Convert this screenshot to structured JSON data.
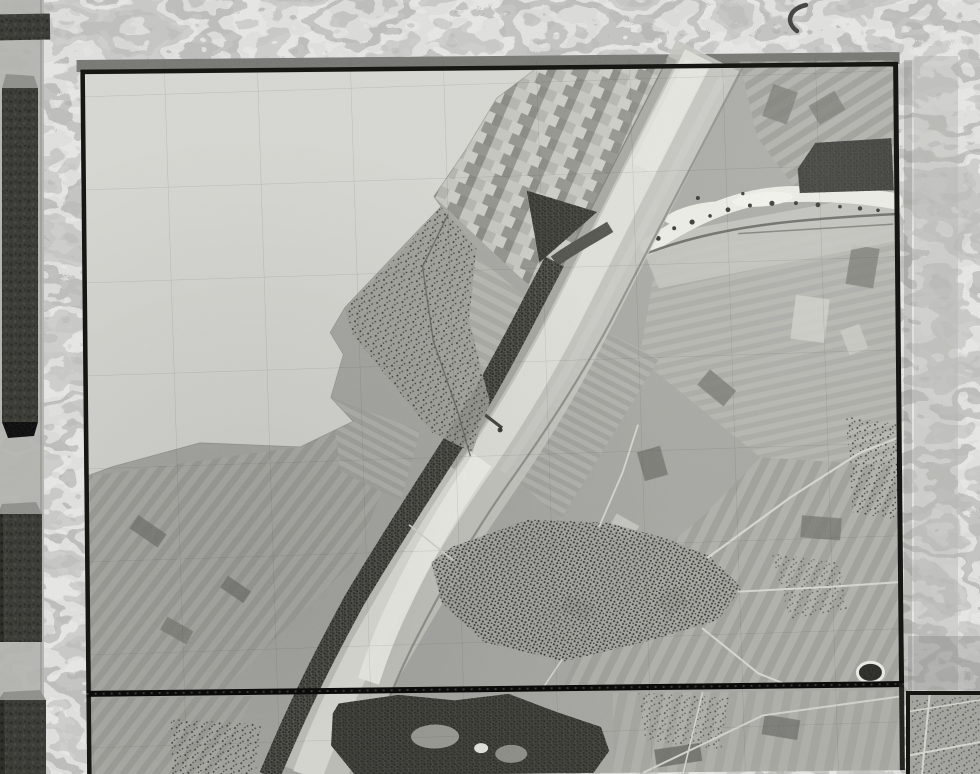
{
  "document": {
    "kind": "archival aerial photomosaic album page",
    "note": "grayscale vertical aerial survey mosaic (river/canal with villages and strip fields) mounted on a marbled album page; no visible text, labels or UI controls"
  },
  "palette": {
    "marble_base": "#9e9e9a",
    "tape": "#b2b2ae",
    "block_dark": "#30302b",
    "block_bevel": "#8d8d89",
    "sheet_shadow": "#747470",
    "border": "#161613",
    "divider": "#0b0b09",
    "paper_blank": "#d9d9d4",
    "photo_base": "#a7a7a2",
    "patch_tint": "#b9b9b3",
    "corridor": "#c8c8c2",
    "water": "#e2e2dc",
    "water_bright": "#f4f4ee",
    "sandbar": "#efefe8",
    "meadow": "#c5c5bf",
    "woods_base": "#4a4a44",
    "forest_base": "#3b3b35",
    "village_ground": "#a0a09a",
    "road_light": "#d8d8d2",
    "road_dark": "#5a5a54",
    "dike_dark": "#85857f",
    "pond_rim": "#eeeee8",
    "pond_fill": "#21211d",
    "grid_line": "#2d2d28",
    "margin_band": "#b6b6b2"
  },
  "geometry": {
    "canvas": {
      "width": 980,
      "height": 774
    },
    "main_sheet": {
      "x": 84,
      "y": 66,
      "width": 817,
      "height": 708
    },
    "divider_y": 690,
    "corner_sheet": {
      "x": 906,
      "y": 691,
      "width": 74,
      "height": 83
    },
    "grid": {
      "spacing_px": 93,
      "tilt_deg": -1.3
    }
  },
  "features": {
    "blank_area_points": "84,70 538,70 500,98 468,150 436,196 443,206 404,246 346,306 331,331 344,353 331,396 353,420 300,445 200,440 112,463 84,473",
    "checkerboard_points": "538,70 668,70 548,302 505,262 436,196 468,150 500,98",
    "woods_triangle_points": "529,191 599,213 541,263",
    "dark_block_topright_points": "800,172 818,146 894,142 896,194 802,196",
    "canal": {
      "corridor_d": "M 712,58 L 576,320 C 544,382 512,432 474,486 C 436,540 402,596 368,654 C 344,696 322,734 306,774",
      "water_d": "M 702,58 L 566,320 C 534,380 504,428 468,478 C 432,530 398,586 364,644 C 342,686 320,730 304,774",
      "bright_d": "M 482,460 C 448,508 420,556 396,606 C 384,630 374,656 366,680",
      "upper_bright_d": "M 700,66 L 646,170",
      "left_dike_d": "M 676,60 L 542,318 C 512,372 484,418 450,466",
      "towpath_d": "M 726,80 L 596,320 C 566,376 536,424 502,472",
      "right_dike_d": "M 748,66 L 612,322 C 580,380 548,428 512,478 C 474,530 440,588 410,646 C 390,686 372,728 360,774",
      "woods_upper_d": "M 612,228 C 592,240 572,250 556,262",
      "woods_d": "M 556,262 C 520,330 488,392 456,438 C 422,490 386,544 352,600 C 320,658 296,704 266,774"
    },
    "old_channel": {
      "meadow_points": "640,240 897,195 897,245 660,290",
      "shore_d": "M 650,248 C 700,215 745,198 790,197 C 835,196 870,200 897,205",
      "dark_shore_d": "M 648,255 C 720,228 800,222 897,218",
      "dark_shore2_d": "M 740,236 L 895,228"
    },
    "bridge_d": "M 466,400 L 502,428",
    "village_band_points": "443,206 478,248 470,320 490,402 472,452 432,432 394,384 354,334 346,308 406,248",
    "village_band_road_d": "M 450,214 L 424,266 L 434,340 L 458,412 L 470,456",
    "big_village_points": "452,546 528,520 608,524 664,540 708,558 740,590 716,622 648,642 562,662 482,642 440,602 430,562",
    "village_roads": [
      "M 706,560 L 790,500 L 860,456 L 897,442",
      "M 736,594 L 830,590 L 897,586",
      "M 700,630 L 756,676 L 788,689",
      "M 598,528 L 622,474 L 638,426",
      "M 452,560 L 408,524",
      "M 560,660 L 540,689"
    ],
    "forest_points": "336,702 396,694 452,700 506,694 552,712 598,728 606,752 590,774 352,774 328,744 330,712",
    "pond_d": "M 855,676 a 13,10 0 1 0 26,0 a 13,10 0 1 0 -26,0",
    "lower_roads": [
      "M 640,774 L 760,718 L 900,700",
      "M 700,694 L 680,774"
    ],
    "corner_roads": [
      "M 906,756 L 980,742",
      "M 930,691 L 922,774",
      "M 906,712 L 980,700"
    ],
    "marble_crescent_d": "M 806,5 C 789,9 785,22 797,31"
  }
}
